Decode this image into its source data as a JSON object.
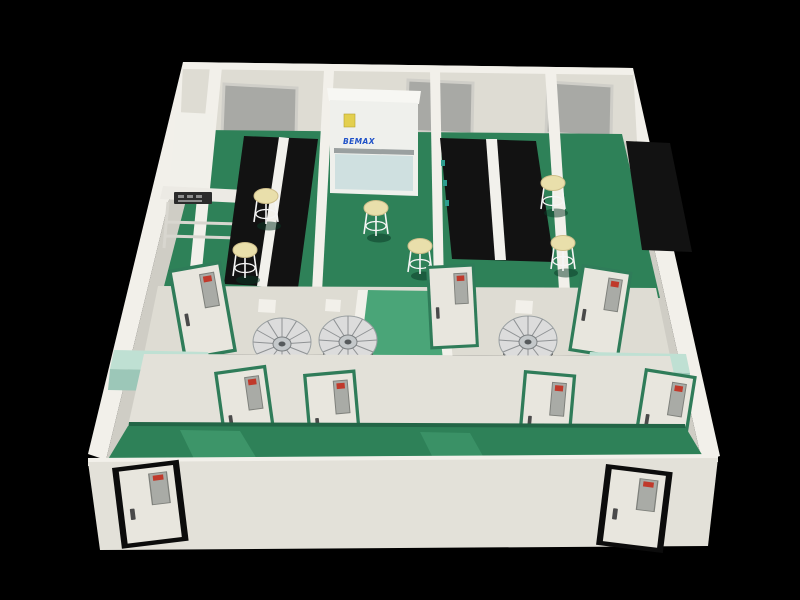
{
  "scene": {
    "description": "3D cutaway render of a cleanroom laboratory suite with green epoxy floors, white partition walls, black lab benches and pass-through equipment",
    "view": "isometric cutaway on black background"
  },
  "cabinet": {
    "brand": "BEMAX",
    "sticker": "yellow-warning-label"
  },
  "inventory": {
    "back_wall_windows": 3,
    "lab_stools": 6,
    "fan_units": 3,
    "green_frame_doors": 7,
    "black_frame_entry_doors": 2,
    "black_lab_benches": 3,
    "wall_counters": 2,
    "biosafety_cabinet": 1,
    "fume_workstation": 1
  },
  "colors": {
    "background": "#000000",
    "wall": "#dedcd3",
    "wall-low": "#e3e1d9",
    "wall-light": "#f2f0ea",
    "wall-shadow": "#cfcdc5",
    "floor-green": "#2e8158",
    "floor-green-dark": "#226546",
    "floor-green-light": "#4aa578",
    "bench-black": "#121212",
    "counter-mint": "#bfe0d3",
    "counter-mint-dark": "#9cc7b8",
    "stool-seat": "#e9dfab",
    "stool-leg": "#f5f5f5",
    "door-frame-green": "#2f7c59",
    "door-frame-black": "#0c0c0c",
    "door-leaf": "#e8e6de",
    "vision-panel": "#a9aba6",
    "vision-panel-dark": "#7e807b",
    "sign-red": "#c0392b",
    "window-glass": "#a8a9a5",
    "window-frame": "#cfcec8",
    "cabinet-white": "#eff0ec",
    "cabinet-glass": "#cfe0e0",
    "brand-blue": "#1f51c8",
    "sticker-yellow": "#e3cf4e",
    "fan-metal": "#dcdcdc",
    "fan-dark": "#343434",
    "bottle-teal": "#2e9d8f",
    "equipment-dark": "#2b2b2b"
  }
}
